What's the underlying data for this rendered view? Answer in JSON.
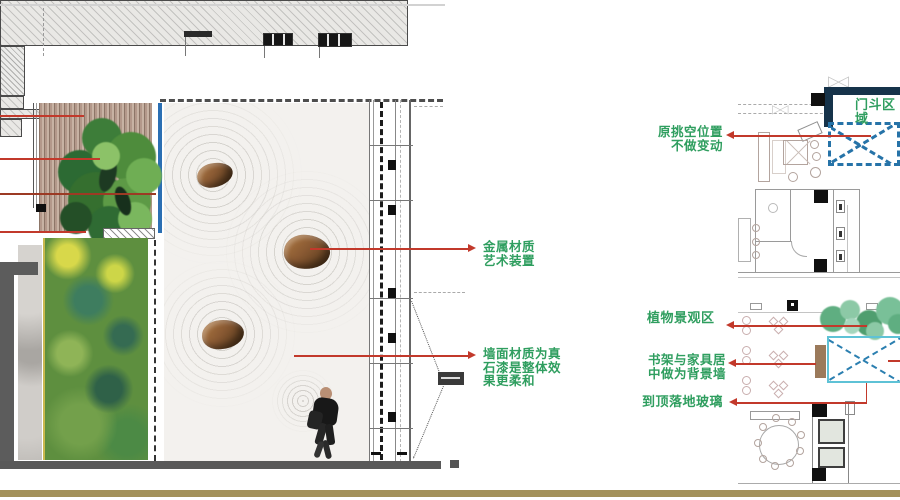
{
  "slide": {
    "annotations": {
      "metal_art": "金属材质\n艺术装置",
      "wall_material": "墙面材质为真\n石漆是整体效\n果更柔和",
      "original_void": "原挑空位置\n不做变动",
      "vestibule_zone": "门斗区域",
      "plant_zone": "植物景观区",
      "bookshelf_wall": "书架与家具居\n中做为背景墙",
      "glass_wall": "到顶落地玻璃"
    },
    "colors": {
      "annotation_green": "#2f9e5f",
      "leader_red": "#c2392b",
      "void_dash_blue": "#2673a8",
      "frame_cyan": "#5ec2d6",
      "wall_navy": "#16334a",
      "deck_wood_tan": "#b3988a",
      "moss_green": "#5e8f3f",
      "sand_white": "#f3f1ee",
      "rock_brown": "#8a5a33",
      "glass_edge_blue": "#2b6fb3",
      "footer_bar_tan": "#a3915a"
    }
  }
}
